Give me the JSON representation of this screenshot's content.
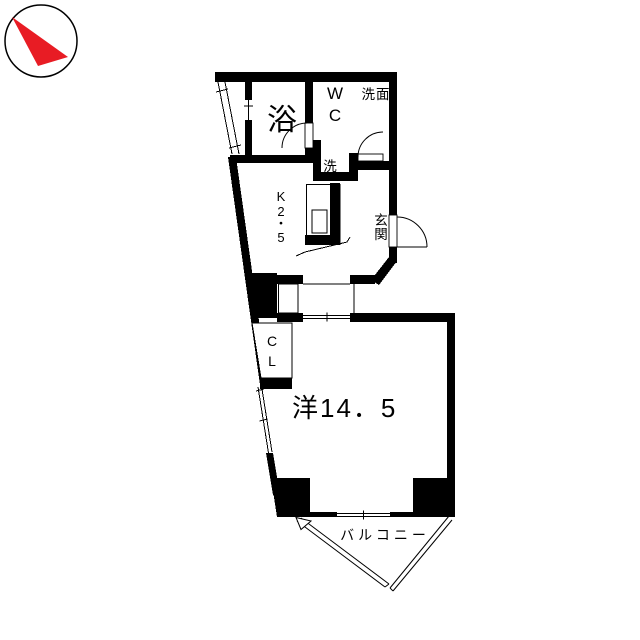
{
  "colors": {
    "wall": "#000000",
    "bg": "#ffffff",
    "arrow": "#e81c24"
  },
  "compass": {
    "icon": "north-arrow"
  },
  "rooms": {
    "bath": {
      "label": "浴"
    },
    "toilet": {
      "chars": [
        "W",
        "C"
      ]
    },
    "washbasin": {
      "label": "洗面"
    },
    "laundry": {
      "label": "洗"
    },
    "kitchen": {
      "chars": [
        "K",
        "2",
        "・",
        "5"
      ]
    },
    "entrance": {
      "chars": [
        "玄",
        "関"
      ]
    },
    "closet": {
      "chars": [
        "C",
        "L"
      ]
    },
    "western_room": {
      "label": "洋14．5"
    },
    "balcony": {
      "label": "バルコニー"
    }
  }
}
